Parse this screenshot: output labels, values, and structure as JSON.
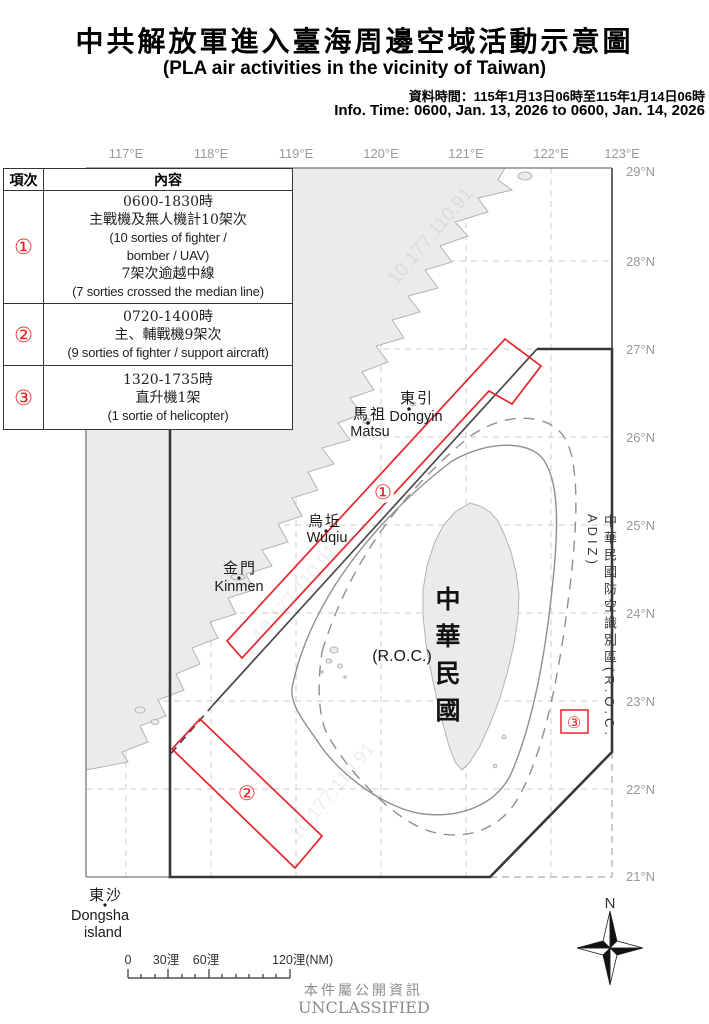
{
  "header": {
    "title_zh": "中共解放軍進入臺海周邊空域活動示意圖",
    "title_en": "(PLA air activities in the vicinity of Taiwan)",
    "data_time": "資料時間：115年1月13日06時至115年1月14日06時",
    "info_time": "Info. Time: 0600, Jan. 13, 2026 to 0600, Jan. 14, 2026"
  },
  "activity_table": {
    "col_index": "項次",
    "col_content": "內容",
    "rows": [
      {
        "num": "①",
        "lines": [
          "0600-1830時",
          "主戰機及無人機計10架次",
          "(10 sorties of fighter /",
          "bomber / UAV)",
          "7架次逾越中線",
          "(7 sorties crossed the median line)"
        ]
      },
      {
        "num": "②",
        "lines": [
          "0720-1400時",
          "主、輔戰機9架次",
          "(9 sorties of fighter / support aircraft)"
        ]
      },
      {
        "num": "③",
        "lines": [
          "1320-1735時",
          "直升機1架",
          "(1 sortie of helicopter)"
        ]
      }
    ]
  },
  "map": {
    "lon_labels": [
      "117°E",
      "118°E",
      "119°E",
      "120°E",
      "121°E",
      "122°E",
      "123°E"
    ],
    "lat_labels": [
      "29°N",
      "28°N",
      "27°N",
      "26°N",
      "25°N",
      "24°N",
      "23°N",
      "22°N",
      "21°N"
    ],
    "places": {
      "dongyin_zh": "東引",
      "dongyin_en": "Dongyin",
      "matsu_zh": "馬祖",
      "matsu_en": "Matsu",
      "wuqiu_zh": "烏坵",
      "wuqiu_en": "Wuqiu",
      "kinmen_zh": "金門",
      "kinmen_en": "Kinmen",
      "dongsha_zh": "東沙",
      "dongsha_en1": "Dongsha",
      "dongsha_en2": "island",
      "roc_paren": "(R.O.C.)",
      "roc_vertical": "中華民國",
      "adiz_vertical": "中華民國防空識別區(R.O.C. ADIZ)"
    },
    "markers": {
      "m1": "①",
      "m2": "②",
      "m3": "③"
    },
    "scalebar": {
      "t0": "0",
      "t30": "30浬",
      "t60": "60浬",
      "t120": "120浬(NM)"
    },
    "compass_n": "N",
    "watermark": "10.177.110.91"
  },
  "footer": {
    "classification_zh": "本件屬公開資訊",
    "classification_en": "UNCLASSIFIED"
  },
  "colors": {
    "accent_red": "#e52528",
    "land_fill": "#ebebeb",
    "coast_stroke": "#b3b3b3",
    "grid": "#cccccc",
    "boundary_dark": "#383838",
    "label_gray": "#999999"
  }
}
